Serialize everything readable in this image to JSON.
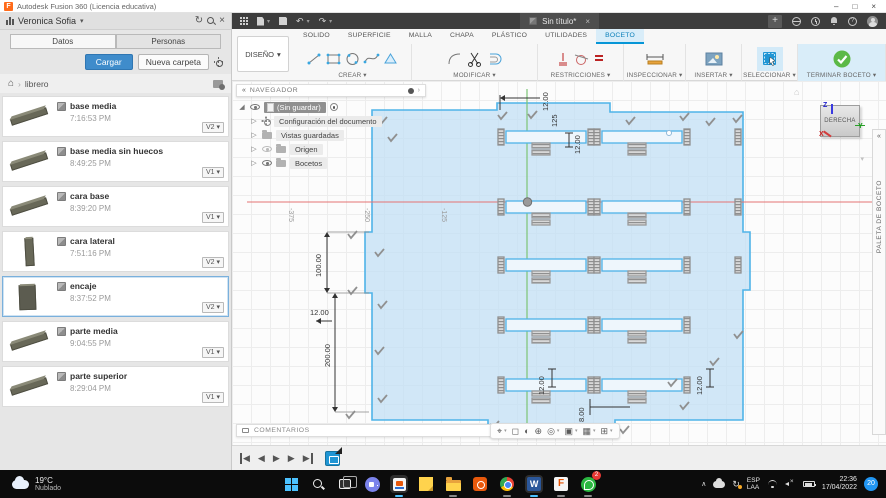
{
  "colors": {
    "accent": "#0696d7",
    "success_green": "#5cb947",
    "selection_blue": "#1f95d4",
    "sketch_fill": "#cde3f4",
    "sketch_line": "#4fb3e8"
  },
  "window": {
    "title": "Autodesk Fusion 360 (Licencia educativa)"
  },
  "doc_tab": {
    "label": "Sin título*"
  },
  "data_panel": {
    "user": "Veronica Sofia",
    "tabs": {
      "datos": "Datos",
      "personas": "Personas"
    },
    "upload": "Cargar",
    "new_folder": "Nueva carpeta",
    "breadcrumb_folder": "librero",
    "items": [
      {
        "name": "base media",
        "time": "7:16:53 PM",
        "version": "V2"
      },
      {
        "name": "base media sin huecos",
        "time": "8:49:25 PM",
        "version": "V1"
      },
      {
        "name": "cara base",
        "time": "8:39:20 PM",
        "version": "V1"
      },
      {
        "name": "cara lateral",
        "time": "7:51:16 PM",
        "version": "V2"
      },
      {
        "name": "encaje",
        "time": "8:37:52 PM",
        "version": "V2"
      },
      {
        "name": "parte media",
        "time": "9:04:55 PM",
        "version": "V1"
      },
      {
        "name": "parte superior",
        "time": "8:29:04 PM",
        "version": "V1"
      }
    ]
  },
  "ribbon": {
    "design": "DISEÑO",
    "tabs": [
      "SOLIDO",
      "SUPERFICIE",
      "MALLA",
      "CHAPA",
      "PLÁSTICO",
      "UTILIDADES",
      "BOCETO"
    ],
    "active_tab": "BOCETO",
    "groups": {
      "crear": "CREAR",
      "modificar": "MODIFICAR",
      "restricciones": "RESTRICCIONES",
      "inspeccionar": "INSPECCIONAR",
      "insertar": "INSERTAR",
      "seleccionar": "SELECCIONAR",
      "terminar": "TERMINAR BOCETO"
    }
  },
  "navigator": {
    "title": "NAVEGADOR",
    "doc": "(Sin guardar)",
    "nodes": [
      {
        "label": "Configuración del documento"
      },
      {
        "label": "Vistas guardadas"
      },
      {
        "label": "Origen"
      },
      {
        "label": "Bocetos"
      }
    ]
  },
  "viewcube": {
    "face": "DERECHA",
    "axis_z": "Z",
    "axis_y": "Y",
    "axis_x": "X"
  },
  "palette": {
    "label": "PALETA DE BOCETO"
  },
  "comments": {
    "label": "COMENTARIOS"
  },
  "sketch": {
    "slot_rows": 5,
    "slot_cols": 2,
    "dims": {
      "d100": "100.00",
      "d200": "200.00",
      "d12_left": "12.00",
      "d12_top": "12.00",
      "d125_top": "125",
      "d12_mid": "12.00",
      "d12_b1": "12.00",
      "d12_b2": "12.00",
      "d8_bottom": "8.00"
    },
    "axis_labels": {
      "a375": "-375",
      "a250": "-250",
      "a125": "-125"
    }
  },
  "taskbar": {
    "temp": "19°C",
    "weather": "Nublado",
    "whatsapp_badge": "2",
    "lang1": "ESP",
    "lang2": "LAA",
    "time": "22:36",
    "date": "17/04/2022",
    "people_badge": "20"
  },
  "icons": {
    "refresh": "↻",
    "close": "×",
    "dropdown": "▾",
    "home": "⌂",
    "crumb_sep": "›",
    "collapse": "«",
    "expand": "›",
    "plus": "+",
    "undo": "↶",
    "redo": "↷",
    "minimize": "–",
    "maximize": "□",
    "win_close": "×",
    "tray_caret": "∧",
    "tri_open": "◢",
    "tri_closed": "▷",
    "tl_back": "◀",
    "tl_play": "▶",
    "vn_pan": "⌖",
    "vn_lookat": "◻",
    "vn_orbit": "◐",
    "vn_zoomwin": "⊕",
    "vn_zoom": "◎",
    "vn_display": "▣",
    "vn_grid": "▦",
    "vn_viewports": "⊞"
  }
}
